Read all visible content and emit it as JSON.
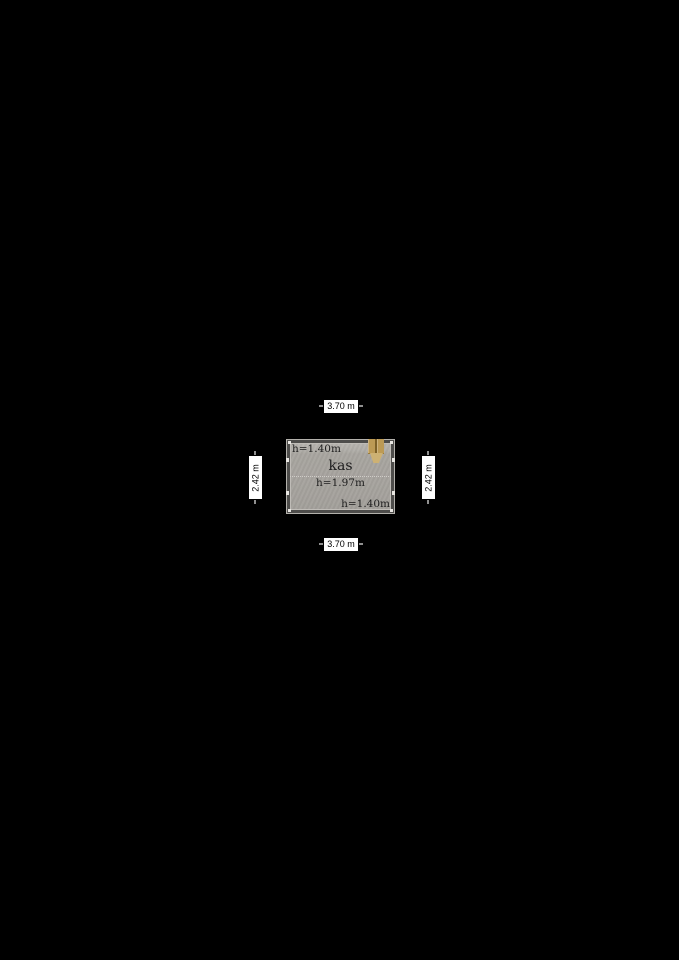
{
  "floor_plan": {
    "room": {
      "name": "kas",
      "center_height": "h=1.97m",
      "top_height": "h=1.40m",
      "bottom_height": "h=1.40m"
    },
    "dimensions": {
      "top": "3.70 m",
      "bottom": "3.70 m",
      "left": "2.42 m",
      "right": "2.42 m"
    },
    "icons": {
      "door": "door-icon"
    },
    "colors": {
      "background": "#000000",
      "floor": "#a6a39e",
      "floor_highlight": "#b7b4af",
      "wall": "#4e4d4b",
      "wall_edge_light": "#bfbcb7",
      "ridge_line_dotted": "#cfcdc8",
      "tick": "#e8e6e2",
      "door_tan": "#bc9a55",
      "door_tan_light": "#cdb173",
      "door_tan_dark": "#7d6128",
      "dimension_label_bg": "#ffffff",
      "dimension_label_text": "#000000",
      "plan_text": "#1d1d1d"
    }
  }
}
